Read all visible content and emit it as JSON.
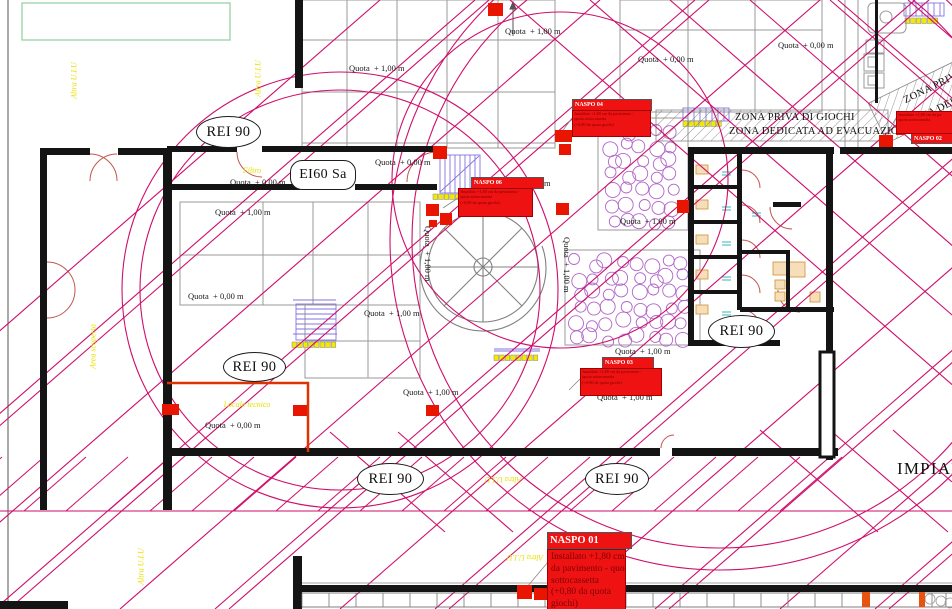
{
  "drawing": {
    "plan_title_partial": "IMPIAN",
    "colors": {
      "hatch_magenta": "#cf0e6b",
      "alarm_red": "#ee1212",
      "zone_yellow": "#e9e000",
      "wall_black": "#141414",
      "grid_gray": "#9a9a9a",
      "stair_purple": "#8673e0",
      "play_circle_purple": "#b266c9"
    },
    "fire_ratings": [
      {
        "text": "REI 90",
        "x": 196,
        "y": 116,
        "w": 63,
        "h": 30,
        "shape": "ellipse"
      },
      {
        "text": "REI 90",
        "x": 223,
        "y": 352,
        "w": 61,
        "h": 28,
        "shape": "ellipse"
      },
      {
        "text": "REI 90",
        "x": 708,
        "y": 315,
        "w": 65,
        "h": 31,
        "shape": "ellipse"
      },
      {
        "text": "REI 90",
        "x": 357,
        "y": 463,
        "w": 65,
        "h": 30,
        "shape": "ellipse"
      },
      {
        "text": "REI 90",
        "x": 585,
        "y": 463,
        "w": 62,
        "h": 30,
        "shape": "ellipse"
      },
      {
        "text": "EI60 Sa",
        "x": 290,
        "y": 160,
        "w": 64,
        "h": 28,
        "shape": "stadium"
      }
    ],
    "zone_band": {
      "line1": "ZONA PRIVA DI GIOCHI",
      "line2": "ZONA DEDICATA AD EVACUAZIONE",
      "rot_line1": "ZONA PRIVA DI",
      "rot_line2": "ZONA DEDICATA AD"
    },
    "naspo_boxes": [
      {
        "label": "NASPO 01",
        "header": {
          "x": 547,
          "y": 532,
          "w": 81,
          "h": 15,
          "fs": 10.5
        },
        "body": {
          "x": 547,
          "y": 549,
          "w": 77,
          "h": 59,
          "big": true
        },
        "lines": [
          "Installato +1,80 cm",
          "da pavimento - quota",
          "sottocassetta",
          "(+0,80 da quota",
          "giochi)"
        ]
      },
      {
        "label": "NASPO 04",
        "header": {
          "x": 572,
          "y": 99,
          "w": 76,
          "h": 10,
          "fs": 6
        },
        "body": {
          "x": 572,
          "y": 110,
          "w": 77,
          "h": 25
        },
        "lines": [
          "Installato +1,80 cm da pavimento -",
          "quota sottocassetta",
          "(+0,80 da quota giochi)"
        ]
      },
      {
        "label": "NASPO 06",
        "header": {
          "x": 471,
          "y": 177,
          "w": 69,
          "h": 10,
          "fs": 6
        },
        "body": {
          "x": 458,
          "y": 188,
          "w": 73,
          "h": 27
        },
        "lines": [
          "Installato +1,80 cm da pavimento -",
          "quota sottocassetta",
          "(+0,80 da quota giochi)"
        ]
      },
      {
        "label": "NASPO 03",
        "header": {
          "x": 602,
          "y": 357,
          "w": 48,
          "h": 10,
          "fs": 6
        },
        "body": {
          "x": 580,
          "y": 368,
          "w": 80,
          "h": 26
        },
        "lines": [
          "Installato +1,80 cm da pavimento -",
          "quota sottocassetta",
          "(+0,80 da quota giochi)"
        ]
      },
      {
        "label": "NASPO 02",
        "header": {
          "x": 911,
          "y": 133,
          "w": 41,
          "h": 9,
          "fs": 6
        },
        "body": {
          "x": 896,
          "y": 111,
          "w": 56,
          "h": 21
        },
        "lines": [
          "Installato +1,80 cm da pa-",
          "quota sottocassetta"
        ]
      }
    ],
    "quota_labels": [
      {
        "text": "Quota  + 1,00 m",
        "x": 349,
        "y": 63,
        "rot": 0
      },
      {
        "text": "Quota  + 1,00 m",
        "x": 505,
        "y": 26,
        "rot": 0
      },
      {
        "text": "Quota  + 0,00 m",
        "x": 638,
        "y": 54,
        "rot": 0
      },
      {
        "text": "Quota  + 0,00 m",
        "x": 778,
        "y": 40,
        "rot": 0
      },
      {
        "text": "Quota  + 0,00 m",
        "x": 375,
        "y": 157,
        "rot": 0
      },
      {
        "text": "Quota  + 0,00 m",
        "x": 230,
        "y": 177,
        "rot": 0
      },
      {
        "text": "Quota  + 1,00 m",
        "x": 215,
        "y": 207,
        "rot": 0
      },
      {
        "text": "Quota  + 0,00 m",
        "x": 188,
        "y": 291,
        "rot": 0
      },
      {
        "text": "Quota  + 1,00 m",
        "x": 364,
        "y": 308,
        "rot": 0
      },
      {
        "text": "Quota  + 1,00 m",
        "x": 403,
        "y": 387,
        "rot": 0
      },
      {
        "text": "Quota  + 1,00 m",
        "x": 615,
        "y": 346,
        "rot": 0
      },
      {
        "text": "Quota  + 1,00 m",
        "x": 597,
        "y": 392,
        "rot": 0
      },
      {
        "text": "Quota  + 1,00 m",
        "x": 620,
        "y": 216,
        "rot": 0
      },
      {
        "text": "Quota  + 0,00 m",
        "x": 205,
        "y": 420,
        "rot": 0
      },
      {
        "text": "Quota  + 1,00 m",
        "x": 424,
        "y": 226,
        "rot": 90
      },
      {
        "text": "Quota  + 1,00 m",
        "x": 563,
        "y": 237,
        "rot": 90
      },
      {
        "text": "a  + 1,00 m",
        "x": 512,
        "y": 178,
        "rot": 0
      }
    ],
    "area_labels": [
      {
        "text": "Altra U.I.U",
        "cx": 74,
        "cy": 81,
        "rot": -90
      },
      {
        "text": "Altra U.I.U",
        "cx": 258,
        "cy": 79,
        "rot": -90
      },
      {
        "text": "Area scoperta",
        "cx": 93,
        "cy": 347,
        "rot": -90
      },
      {
        "text": "Altra U.I.U",
        "cx": 503,
        "cy": 480,
        "rot": 180
      },
      {
        "text": "Altra U.I.U",
        "cx": 525,
        "cy": 558,
        "rot": 180
      },
      {
        "text": "Altra U.I.U",
        "cx": 141,
        "cy": 567,
        "rot": -90
      },
      {
        "text": "Filtro",
        "cx": 252,
        "cy": 171,
        "rot": 0
      },
      {
        "text": "Locale tecnico",
        "cx": 247,
        "cy": 405,
        "rot": 0
      }
    ],
    "hydrants": [
      {
        "x": 488,
        "y": 3,
        "w": 15,
        "h": 13
      },
      {
        "x": 433,
        "y": 146,
        "w": 14,
        "h": 13
      },
      {
        "x": 426,
        "y": 204,
        "w": 13,
        "h": 12
      },
      {
        "x": 440,
        "y": 213,
        "w": 12,
        "h": 12
      },
      {
        "x": 429,
        "y": 220,
        "w": 8,
        "h": 7
      },
      {
        "x": 556,
        "y": 203,
        "w": 13,
        "h": 12
      },
      {
        "x": 555,
        "y": 130,
        "w": 17,
        "h": 12
      },
      {
        "x": 559,
        "y": 144,
        "w": 12,
        "h": 11
      },
      {
        "x": 162,
        "y": 404,
        "w": 17,
        "h": 11
      },
      {
        "x": 293,
        "y": 405,
        "w": 14,
        "h": 11
      },
      {
        "x": 426,
        "y": 405,
        "w": 13,
        "h": 11
      },
      {
        "x": 677,
        "y": 200,
        "w": 12,
        "h": 13
      },
      {
        "x": 879,
        "y": 135,
        "w": 14,
        "h": 12
      },
      {
        "x": 896,
        "y": 126,
        "w": 9,
        "h": 9
      },
      {
        "x": 517,
        "y": 585,
        "w": 15,
        "h": 14
      },
      {
        "x": 534,
        "y": 588,
        "w": 13,
        "h": 12
      },
      {
        "x": 862,
        "y": 592,
        "w": 8,
        "h": 15,
        "col": true
      },
      {
        "x": 919,
        "y": 592,
        "w": 6,
        "h": 15,
        "col": true
      }
    ]
  }
}
